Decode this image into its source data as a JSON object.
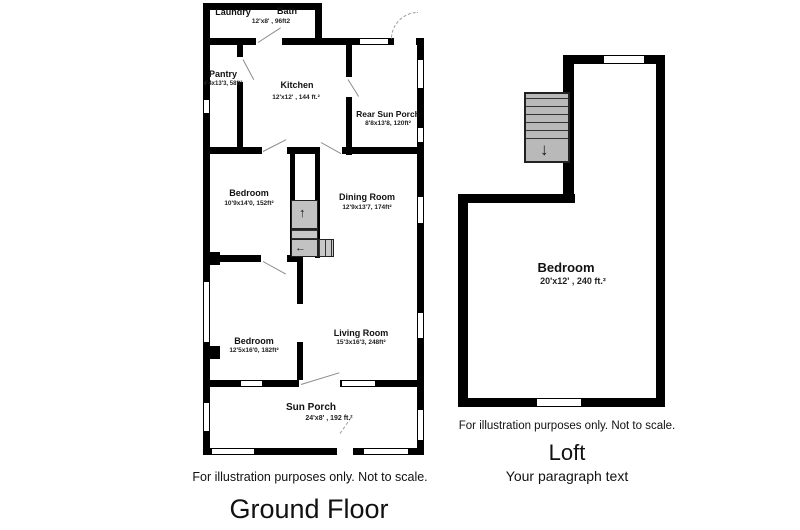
{
  "ground_floor": {
    "title": "Ground Floor",
    "disclaimer": "For illustration purposes only. Not to scale.",
    "rooms": [
      {
        "name": "Laundry",
        "dims": ""
      },
      {
        "name": "Bath",
        "dims": "12'x8' , 96ft2"
      },
      {
        "name": "Pantry",
        "dims": "4'4x13'3, 58ft²"
      },
      {
        "name": "Kitchen",
        "dims": "12'x12' , 144 ft.²"
      },
      {
        "name": "Rear Sun Porch",
        "dims": "8'8x13'8, 120ft²"
      },
      {
        "name": "Bedroom",
        "dims": "10'9x14'0, 152ft²"
      },
      {
        "name": "Dining Room",
        "dims": "12'9x13'7, 174ft²"
      },
      {
        "name": "Bedroom",
        "dims": "12'5x16'0, 182ft²"
      },
      {
        "name": "Living Room",
        "dims": "15'3x16'3, 248ft²"
      },
      {
        "name": "Sun Porch",
        "dims": "24'x8' , 192  ft.²"
      }
    ]
  },
  "loft": {
    "title": "Loft",
    "subtitle": "Your paragraph text",
    "disclaimer": "For illustration purposes only. Not to scale.",
    "rooms": [
      {
        "name": "Bedroom",
        "dims": "20'x12' ,  240 ft.²"
      }
    ]
  },
  "icons": {
    "stair_up_arrow": "↑",
    "stair_left_arrow": "←",
    "stair_down_arrow": "↓"
  },
  "colors": {
    "wall": "#000000",
    "stair_fill": "#c2c2c2",
    "text": "#111111"
  }
}
